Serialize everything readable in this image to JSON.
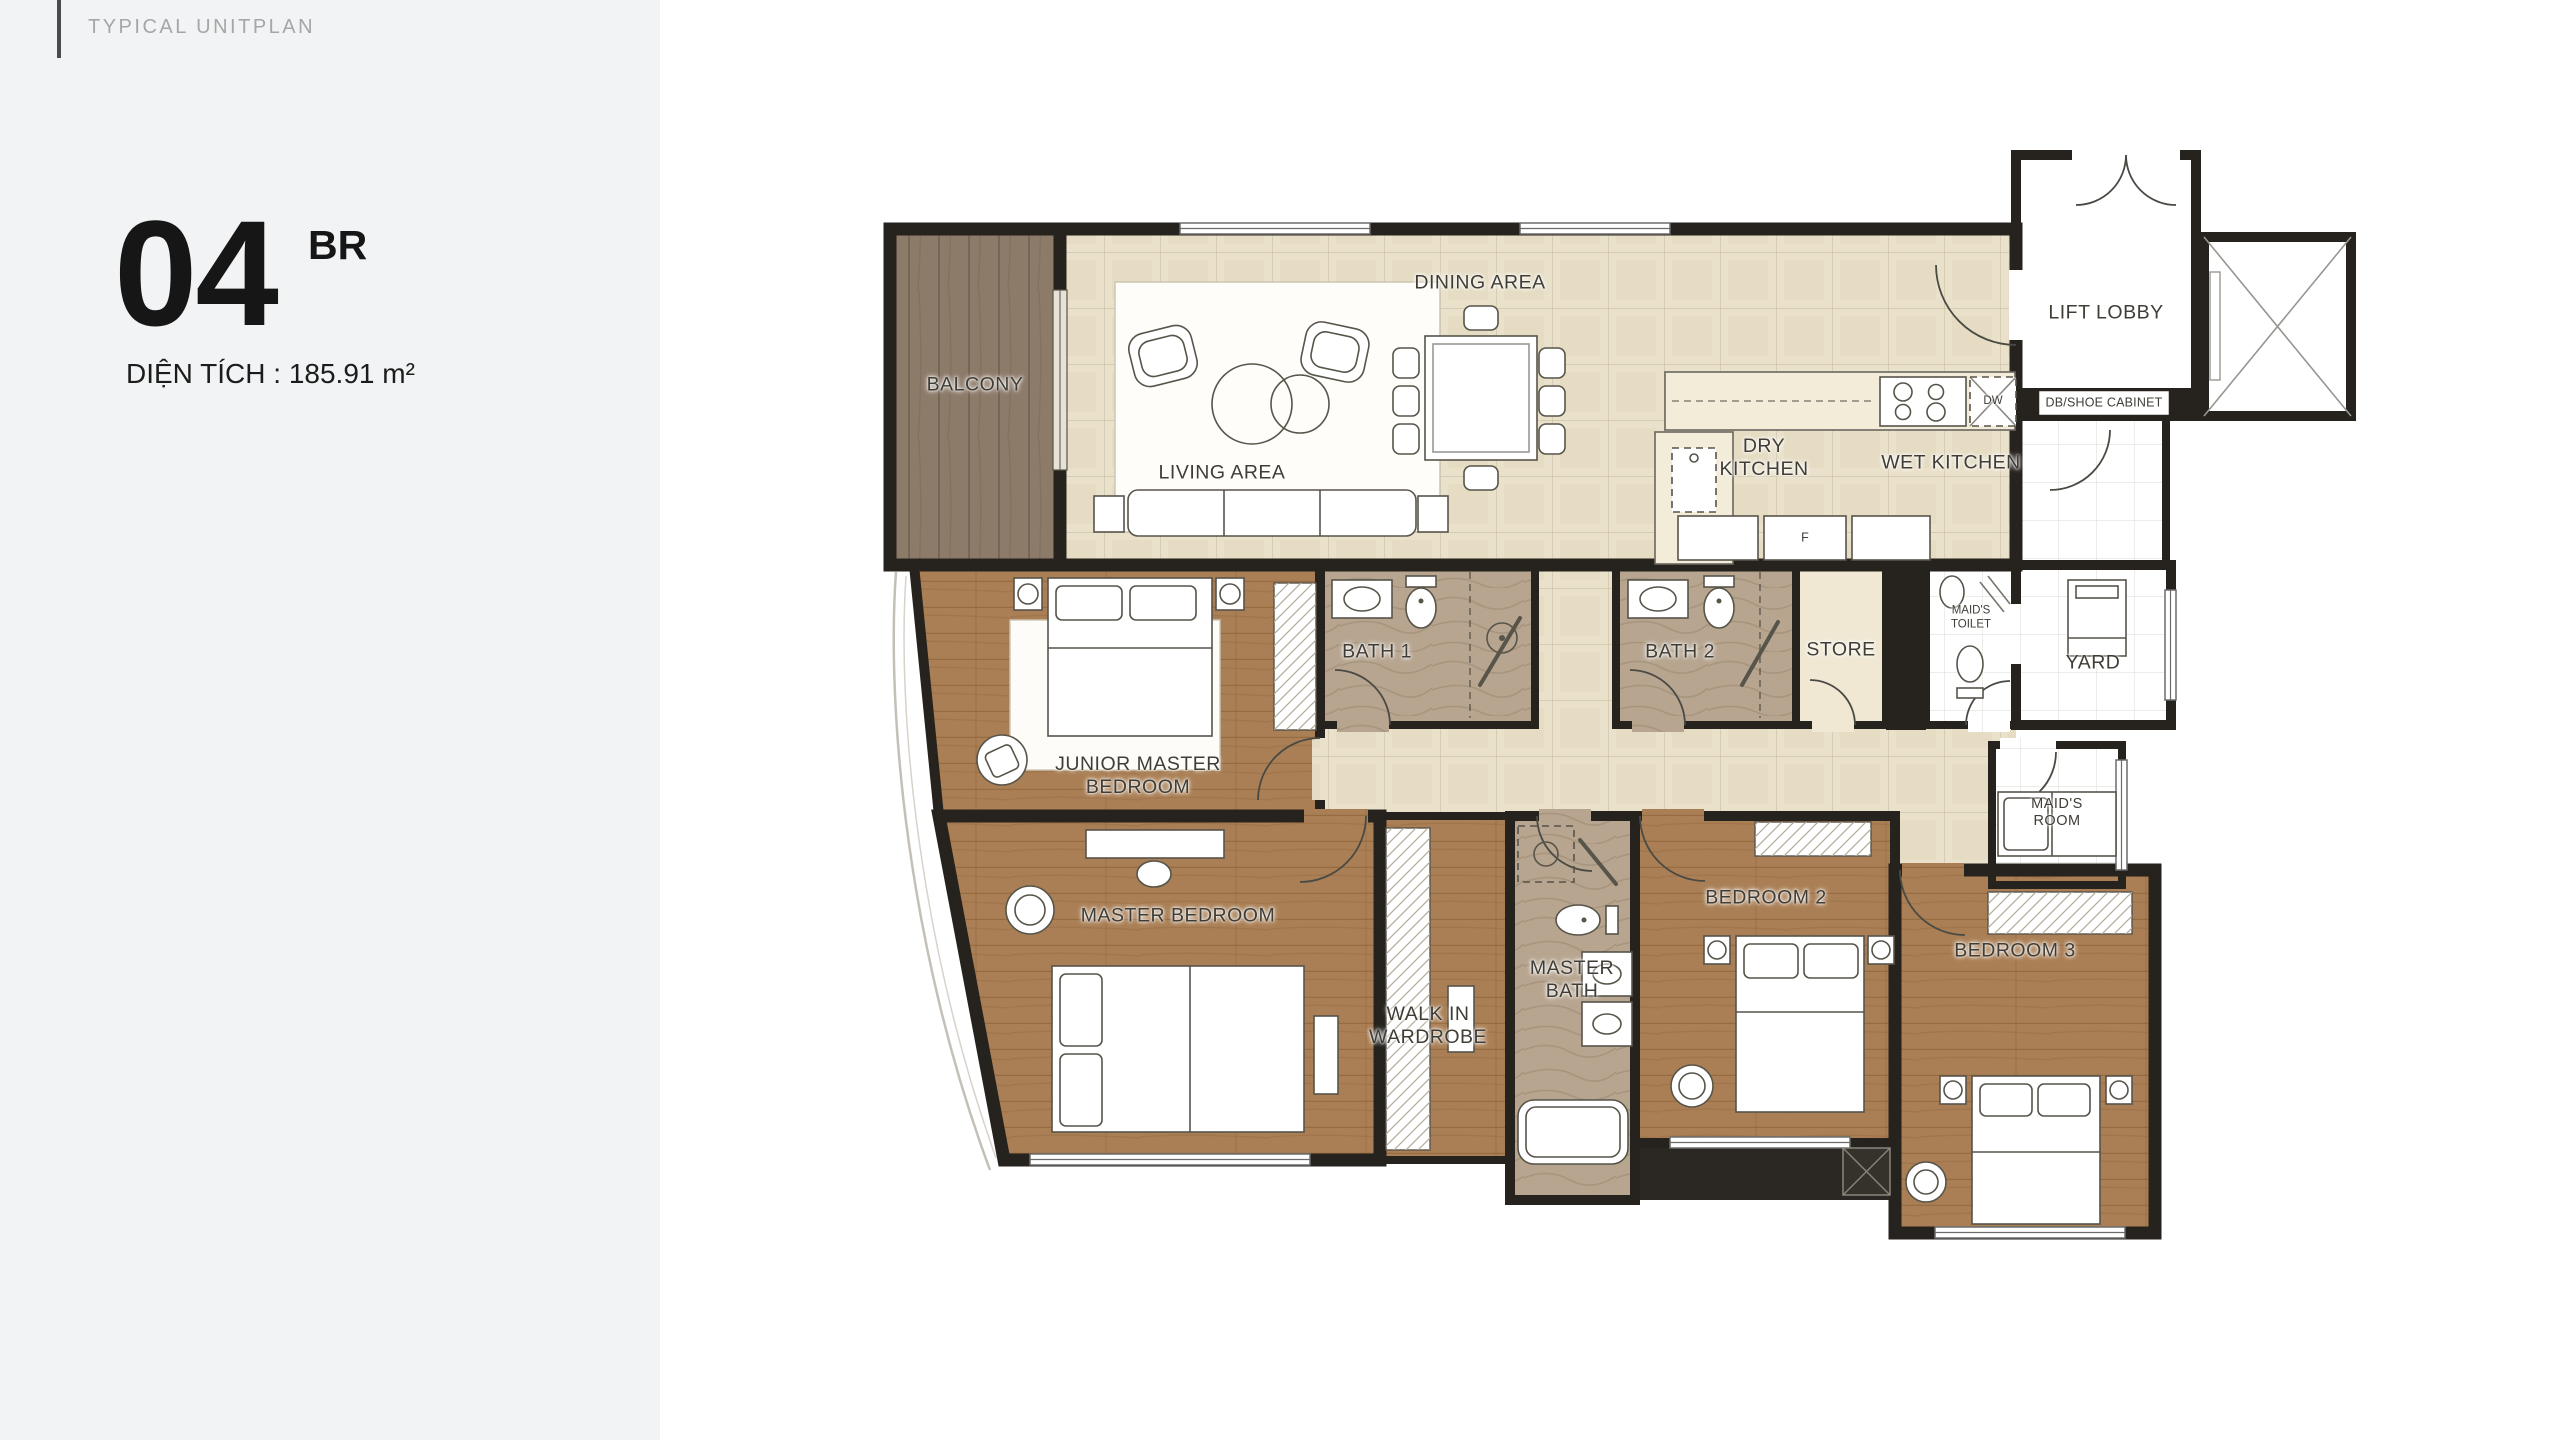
{
  "header": {
    "title": "TYPICAL UNITPLAN"
  },
  "unit": {
    "number": "04",
    "suffix": "BR",
    "area_label": "DIỆN TÍCH : 185.91 m²"
  },
  "plan": {
    "rooms": {
      "balcony": "BALCONY",
      "living": "LIVING AREA",
      "dining": "DINING AREA",
      "dry_kitchen": "DRY KITCHEN",
      "wet_kitchen": "WET KITCHEN",
      "lift_lobby": "LIFT LOBBY",
      "bath1": "BATH 1",
      "bath2": "BATH 2",
      "store": "STORE",
      "maids_toilet": "MAID'S TOILET",
      "yard": "YARD",
      "maids_room": "MAID'S ROOM",
      "junior_master_bedroom": "JUNIOR MASTER BEDROOM",
      "master_bedroom": "MASTER BEDROOM",
      "walk_in_wardrobe": "WALK IN WARDROBE",
      "master_bath": "MASTER BATH",
      "bedroom2": "BEDROOM 2",
      "bedroom3": "BEDROOM 3"
    },
    "fittings": {
      "db_shoe_cabinet": "DB/SHOE CABINET",
      "dishwasher": "DW",
      "fridge": "F"
    },
    "colors": {
      "wall": "#26221d",
      "tile_floor": "#eae1cb",
      "white_floor": "#ffffff",
      "wood_floor": "#aa7f55",
      "balcony_floor": "#8d7b6a",
      "marble_floor": "#b7a590",
      "store_floor": "#f0e8d3",
      "sidebar_bg": "#f2f3f4",
      "canvas_bg": "#ffffff",
      "label_text": "#3f3d36",
      "title_text": "#a6a6a6",
      "accent_bar": "#4b4b4b"
    }
  }
}
